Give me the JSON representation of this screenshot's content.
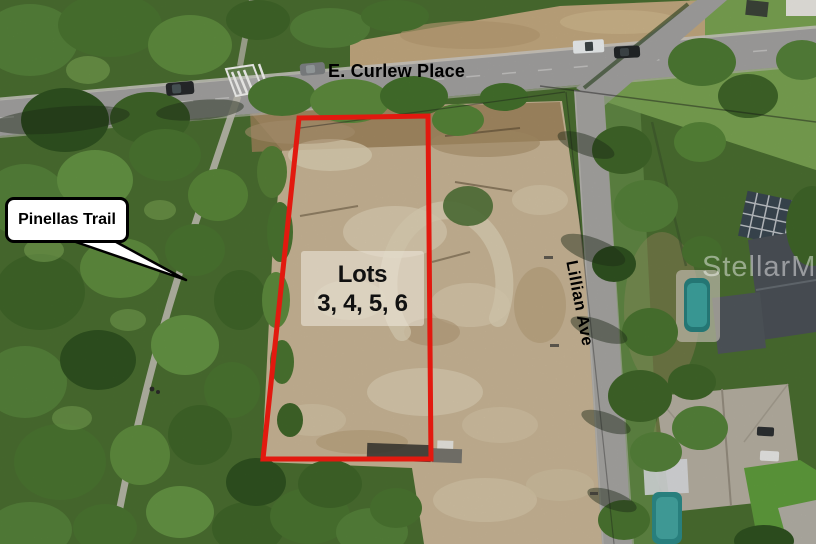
{
  "annotations": {
    "street_top": "E. Curlew Place",
    "street_right": "Lillian Ave",
    "trail_callout": "Pinellas Trail",
    "lot_label": {
      "line1": "Lots",
      "line2": "3, 4, 5, 6"
    },
    "watermark": "StellarMLS"
  },
  "colors": {
    "boundary_red": "#e2190f",
    "callout_background": "#ffffff",
    "callout_border": "#000000",
    "label_text": "#000000",
    "watermark_white": "rgba(255,255,255,0.45)"
  }
}
